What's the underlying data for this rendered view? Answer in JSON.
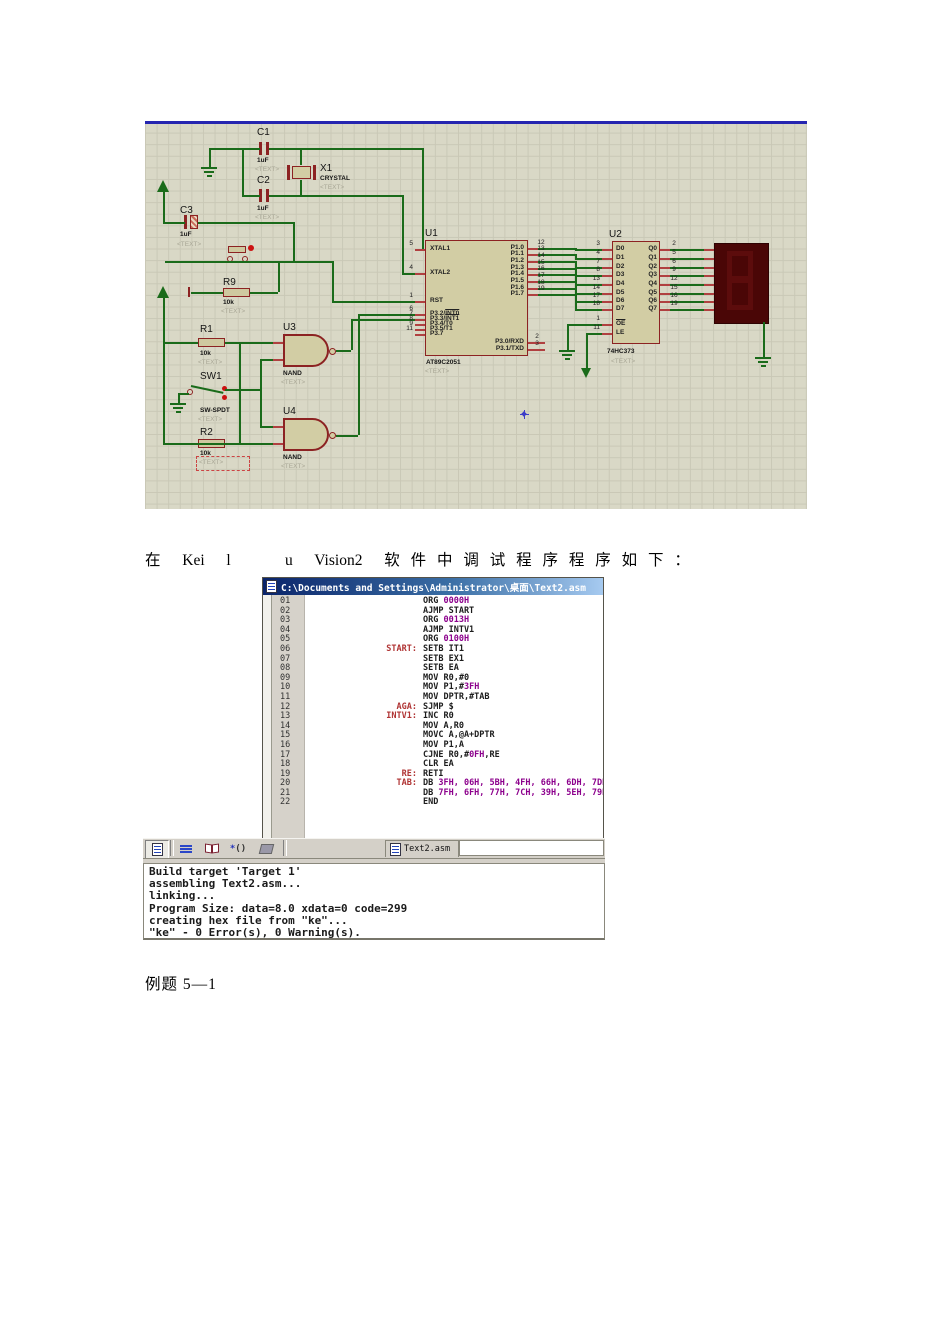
{
  "schematic": {
    "components": {
      "c1": {
        "ref": "C1",
        "value": "1uF",
        "placeholder": "<TEXT>"
      },
      "c2": {
        "ref": "C2",
        "value": "1uF",
        "placeholder": "<TEXT>"
      },
      "c3": {
        "ref": "C3",
        "value": "1uF",
        "placeholder": "<TEXT>"
      },
      "x1": {
        "ref": "X1",
        "value": "CRYSTAL",
        "placeholder": "<TEXT>"
      },
      "r9": {
        "ref": "R9",
        "value": "10k",
        "placeholder": "<TEXT>"
      },
      "r1": {
        "ref": "R1",
        "value": "10k",
        "placeholder": "<TEXT>"
      },
      "r2": {
        "ref": "R2",
        "value": "10k",
        "placeholder": "<TEXT>"
      },
      "sw1": {
        "ref": "SW1",
        "value": "SW-SPDT",
        "placeholder": "<TEXT>"
      },
      "u3": {
        "ref": "U3",
        "value": "NAND",
        "placeholder": "<TEXT>"
      },
      "u4": {
        "ref": "U4",
        "value": "NAND",
        "placeholder": "<TEXT>"
      },
      "u1": {
        "ref": "U1",
        "part": "AT89C2051",
        "placeholder": "<TEXT>",
        "left_pins": [
          {
            "n": "5",
            "l": "XTAL1"
          },
          {
            "n": "4",
            "l": "XTAL2"
          },
          {
            "n": "1",
            "l": "RST"
          },
          {
            "n": "6",
            "l": "P3.2/",
            "ov": "INT0"
          },
          {
            "n": "7",
            "l": "P3.3/",
            "ov": "INT1"
          },
          {
            "n": "8",
            "l": "P3.4/T0"
          },
          {
            "n": "9",
            "l": "P3.5/T1"
          },
          {
            "n": "11",
            "l": "P3.7"
          }
        ],
        "right_pins": [
          {
            "n": "12",
            "l": "P1.0"
          },
          {
            "n": "13",
            "l": "P1.1"
          },
          {
            "n": "14",
            "l": "P1.2"
          },
          {
            "n": "15",
            "l": "P1.3"
          },
          {
            "n": "16",
            "l": "P1.4"
          },
          {
            "n": "17",
            "l": "P1.5"
          },
          {
            "n": "18",
            "l": "P1.6"
          },
          {
            "n": "19",
            "l": "P1.7"
          },
          {
            "n": "2",
            "l": "P3.0/RXD"
          },
          {
            "n": "3",
            "l": "P3.1/TXD"
          }
        ]
      },
      "u2": {
        "ref": "U2",
        "part": "74HC373",
        "placeholder": "<TEXT>",
        "left_pins": [
          {
            "n": "3",
            "l": "D0"
          },
          {
            "n": "4",
            "l": "D1"
          },
          {
            "n": "7",
            "l": "D2"
          },
          {
            "n": "8",
            "l": "D3"
          },
          {
            "n": "13",
            "l": "D4"
          },
          {
            "n": "14",
            "l": "D5"
          },
          {
            "n": "17",
            "l": "D6"
          },
          {
            "n": "18",
            "l": "D7"
          },
          {
            "n": "1",
            "l": "",
            "ov": "OE"
          },
          {
            "n": "11",
            "l": "LE"
          }
        ],
        "right_pins": [
          {
            "n": "2",
            "l": "Q0"
          },
          {
            "n": "5",
            "l": "Q1"
          },
          {
            "n": "6",
            "l": "Q2"
          },
          {
            "n": "9",
            "l": "Q3"
          },
          {
            "n": "12",
            "l": "Q4"
          },
          {
            "n": "15",
            "l": "Q5"
          },
          {
            "n": "16",
            "l": "Q6"
          },
          {
            "n": "19",
            "l": "Q7"
          }
        ]
      }
    }
  },
  "caption": "在  Kei  l     u  Vision2  软 件 中 调 试 程 序 程 序 如 下 ：",
  "editor": {
    "title": "C:\\Documents and Settings\\Administrator\\桌面\\Text2.asm",
    "tab": "Text2.asm",
    "lines": [
      {
        "n": "01",
        "lbl": "",
        "segs": [
          [
            "ORG ",
            "o"
          ],
          [
            "0000H",
            "n"
          ]
        ]
      },
      {
        "n": "02",
        "lbl": "",
        "segs": [
          [
            "AJMP START",
            "o"
          ]
        ]
      },
      {
        "n": "03",
        "lbl": "",
        "segs": [
          [
            "ORG ",
            "o"
          ],
          [
            "0013H",
            "n"
          ]
        ]
      },
      {
        "n": "04",
        "lbl": "",
        "segs": [
          [
            "AJMP INTV1",
            "o"
          ]
        ]
      },
      {
        "n": "05",
        "lbl": "",
        "segs": [
          [
            "ORG ",
            "o"
          ],
          [
            "0100H",
            "n"
          ]
        ]
      },
      {
        "n": "06",
        "lbl": "START:",
        "segs": [
          [
            "SETB IT1",
            "o"
          ]
        ]
      },
      {
        "n": "07",
        "lbl": "",
        "segs": [
          [
            "SETB EX1",
            "o"
          ]
        ]
      },
      {
        "n": "08",
        "lbl": "",
        "segs": [
          [
            "SETB EA",
            "o"
          ]
        ]
      },
      {
        "n": "09",
        "lbl": "",
        "segs": [
          [
            "MOV R0,#0",
            "o"
          ]
        ]
      },
      {
        "n": "10",
        "lbl": "",
        "segs": [
          [
            "MOV P1,#",
            "o"
          ],
          [
            "3FH",
            "n"
          ]
        ]
      },
      {
        "n": "11",
        "lbl": "",
        "segs": [
          [
            "MOV DPTR,#TAB",
            "o"
          ]
        ]
      },
      {
        "n": "12",
        "lbl": "AGA:",
        "segs": [
          [
            "SJMP $",
            "o"
          ]
        ]
      },
      {
        "n": "13",
        "lbl": "INTV1:",
        "segs": [
          [
            "INC R0",
            "o"
          ]
        ]
      },
      {
        "n": "14",
        "lbl": "",
        "segs": [
          [
            "MOV A,R0",
            "o"
          ]
        ]
      },
      {
        "n": "15",
        "lbl": "",
        "segs": [
          [
            "MOVC A,@A+DPTR",
            "o"
          ]
        ]
      },
      {
        "n": "16",
        "lbl": "",
        "segs": [
          [
            "MOV P1,A",
            "o"
          ]
        ]
      },
      {
        "n": "17",
        "lbl": "",
        "segs": [
          [
            "CJNE R0,#",
            "o"
          ],
          [
            "0FH",
            "n"
          ],
          [
            ",RE",
            "o"
          ]
        ]
      },
      {
        "n": "18",
        "lbl": "",
        "segs": [
          [
            "CLR EA",
            "o"
          ]
        ]
      },
      {
        "n": "19",
        "lbl": "RE:",
        "segs": [
          [
            "RETI",
            "o"
          ]
        ]
      },
      {
        "n": "20",
        "lbl": "TAB:",
        "segs": [
          [
            "DB ",
            "o"
          ],
          [
            "3FH, 06H, 5BH, 4FH, 66H, 6DH, 7DH, 07H",
            "n"
          ]
        ]
      },
      {
        "n": "21",
        "lbl": "",
        "segs": [
          [
            "DB ",
            "o"
          ],
          [
            "7FH, 6FH, 77H, 7CH, 39H, 5EH, 79H, 71H",
            "n"
          ]
        ]
      },
      {
        "n": "22",
        "lbl": "",
        "segs": [
          [
            "END",
            "o"
          ]
        ]
      }
    ]
  },
  "toolbar": {
    "tab_label": "Text2.asm"
  },
  "build_output": {
    "lines": [
      "Build target 'Target 1'",
      "assembling Text2.asm...",
      "linking...",
      "Program Size: data=8.0 xdata=0 code=299",
      "creating hex file from \"ke\"...",
      "\"ke\" - 0 Error(s), 0 Warning(s)."
    ]
  },
  "footer": "例题 5—1"
}
